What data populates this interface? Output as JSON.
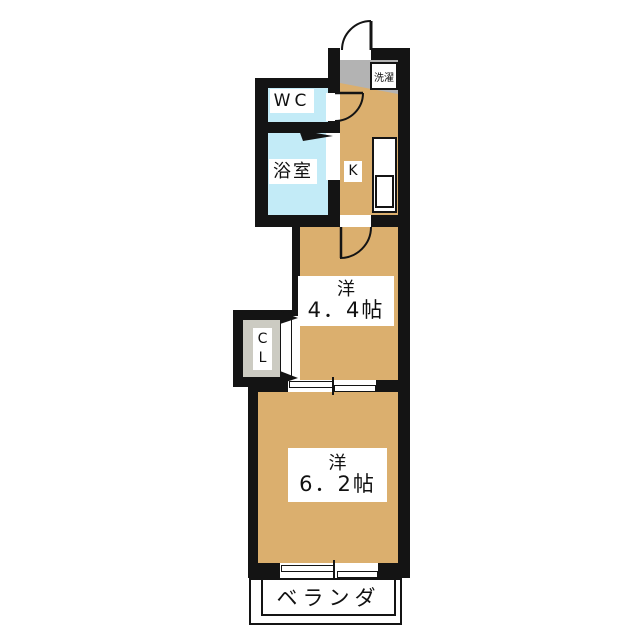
{
  "plan": {
    "rooms": {
      "wc": {
        "label": "WC"
      },
      "bathroom": {
        "label": "浴室"
      },
      "kitchen": {
        "label": "K"
      },
      "laundry": {
        "label": "洗濯"
      },
      "western_room_1": {
        "type": "洋",
        "size": "4．4帖"
      },
      "western_room_2": {
        "type": "洋",
        "size": "6．2帖"
      },
      "closet": {
        "line1": "C",
        "line2": "L"
      },
      "veranda": {
        "label": "ベランダ"
      }
    },
    "colors": {
      "wall": "#141414",
      "wood_floor": "#dbaf6e",
      "wet_area": "#c3ebf7",
      "entry": "#b3b3b3",
      "closet_interior": "#cccbc2"
    }
  }
}
